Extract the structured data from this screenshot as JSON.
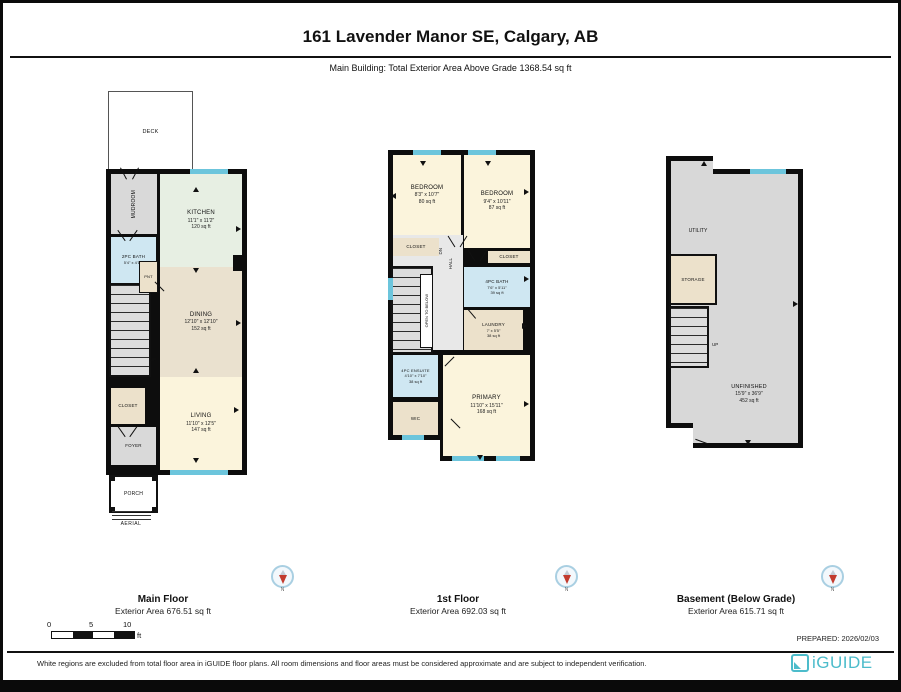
{
  "header": {
    "title": "161 Lavender Manor SE, Calgary, AB",
    "subtitle": "Main Building: Total Exterior Area Above Grade 1368.54 sq ft"
  },
  "plans": {
    "main": {
      "deck": "DECK",
      "aerial": "AERIAL",
      "stairs_dn": "DN",
      "stairs_up": "UP",
      "rooms": {
        "mudroom": {
          "name": "MUDROOM"
        },
        "kitchen": {
          "name": "KITCHEN",
          "dims": "11'1\" x 11'2\"",
          "area": "120 sq ft"
        },
        "bath2pc": {
          "name": "2PC BATH",
          "dims": "5'4\" x 4'11\""
        },
        "pantry": {
          "name": "PNT"
        },
        "dining": {
          "name": "DINING",
          "dims": "12'10\" x 12'10\"",
          "area": "152 sq ft"
        },
        "closet": {
          "name": "CLOSET"
        },
        "foyer": {
          "name": "FOYER"
        },
        "living": {
          "name": "LIVING",
          "dims": "11'10\" x 12'5\"",
          "area": "147 sq ft"
        },
        "porch": {
          "name": "PORCH"
        }
      },
      "footer": {
        "name": "Main Floor",
        "area": "Exterior Area 676.51 sq ft"
      }
    },
    "first": {
      "stairs_dn": "DN",
      "open_below": "OPEN TO BELOW",
      "rooms": {
        "bedroom1": {
          "name": "BEDROOM",
          "dims": "8'3\" x 10'7\"",
          "area": "80 sq ft"
        },
        "bedroom2": {
          "name": "BEDROOM",
          "dims": "9'4\" x 10'11\"",
          "area": "87 sq ft"
        },
        "closet1": {
          "name": "CLOSET"
        },
        "closet2": {
          "name": "CLOSET"
        },
        "hall": {
          "name": "HALL"
        },
        "bath4pc": {
          "name": "4PC BATH",
          "dims": "7'6\" x 5'11\"",
          "area": "39 sq ft"
        },
        "laundry": {
          "name": "LAUNDRY",
          "dims": "7' x 5'5\"",
          "area": "38 sq ft"
        },
        "ensuite": {
          "name": "4PC ENSUITE",
          "dims": "4'10\" x 7'10\"",
          "area": "38 sq ft"
        },
        "wic": {
          "name": "WIC"
        },
        "primary": {
          "name": "PRIMARY",
          "dims": "11'10\" x 15'11\"",
          "area": "168 sq ft"
        }
      },
      "footer": {
        "name": "1st Floor",
        "area": "Exterior Area 692.03 sq ft"
      }
    },
    "basement": {
      "stairs_up": "UP",
      "rooms": {
        "utility": {
          "name": "UTILITY"
        },
        "storage": {
          "name": "STORAGE"
        },
        "unfinished": {
          "name": "UNFINISHED",
          "dims": "15'9\" x 36'9\"",
          "area": "452 sq ft"
        }
      },
      "footer": {
        "name": "Basement (Below Grade)",
        "area": "Exterior Area 615.71 sq ft"
      }
    }
  },
  "compass": {
    "label": "N"
  },
  "scale": {
    "t0": "0",
    "t5": "5",
    "t10": "10",
    "unit": "ft"
  },
  "prepared": "PREPARED: 2026/02/03",
  "footer_bar": {
    "disclaimer": "White regions are excluded from total floor area in iGUIDE floor plans. All room dimensions and floor areas must be considered approximate and are subject to independent verification.",
    "logo": "iGUIDE"
  },
  "colors": {
    "wall": "#0d0d0d",
    "kitchen_green": "#e7efe3",
    "dining_tan": "#eae1cf",
    "room_cream": "#fbf4dc",
    "bath_blue": "#cfe7f2",
    "closet_beige": "#ece1cb",
    "utility_gray": "#d9d9d9",
    "window_cyan": "#6cc5dc",
    "compass_red": "#c23b2e",
    "logo_teal": "#4cbccb"
  }
}
